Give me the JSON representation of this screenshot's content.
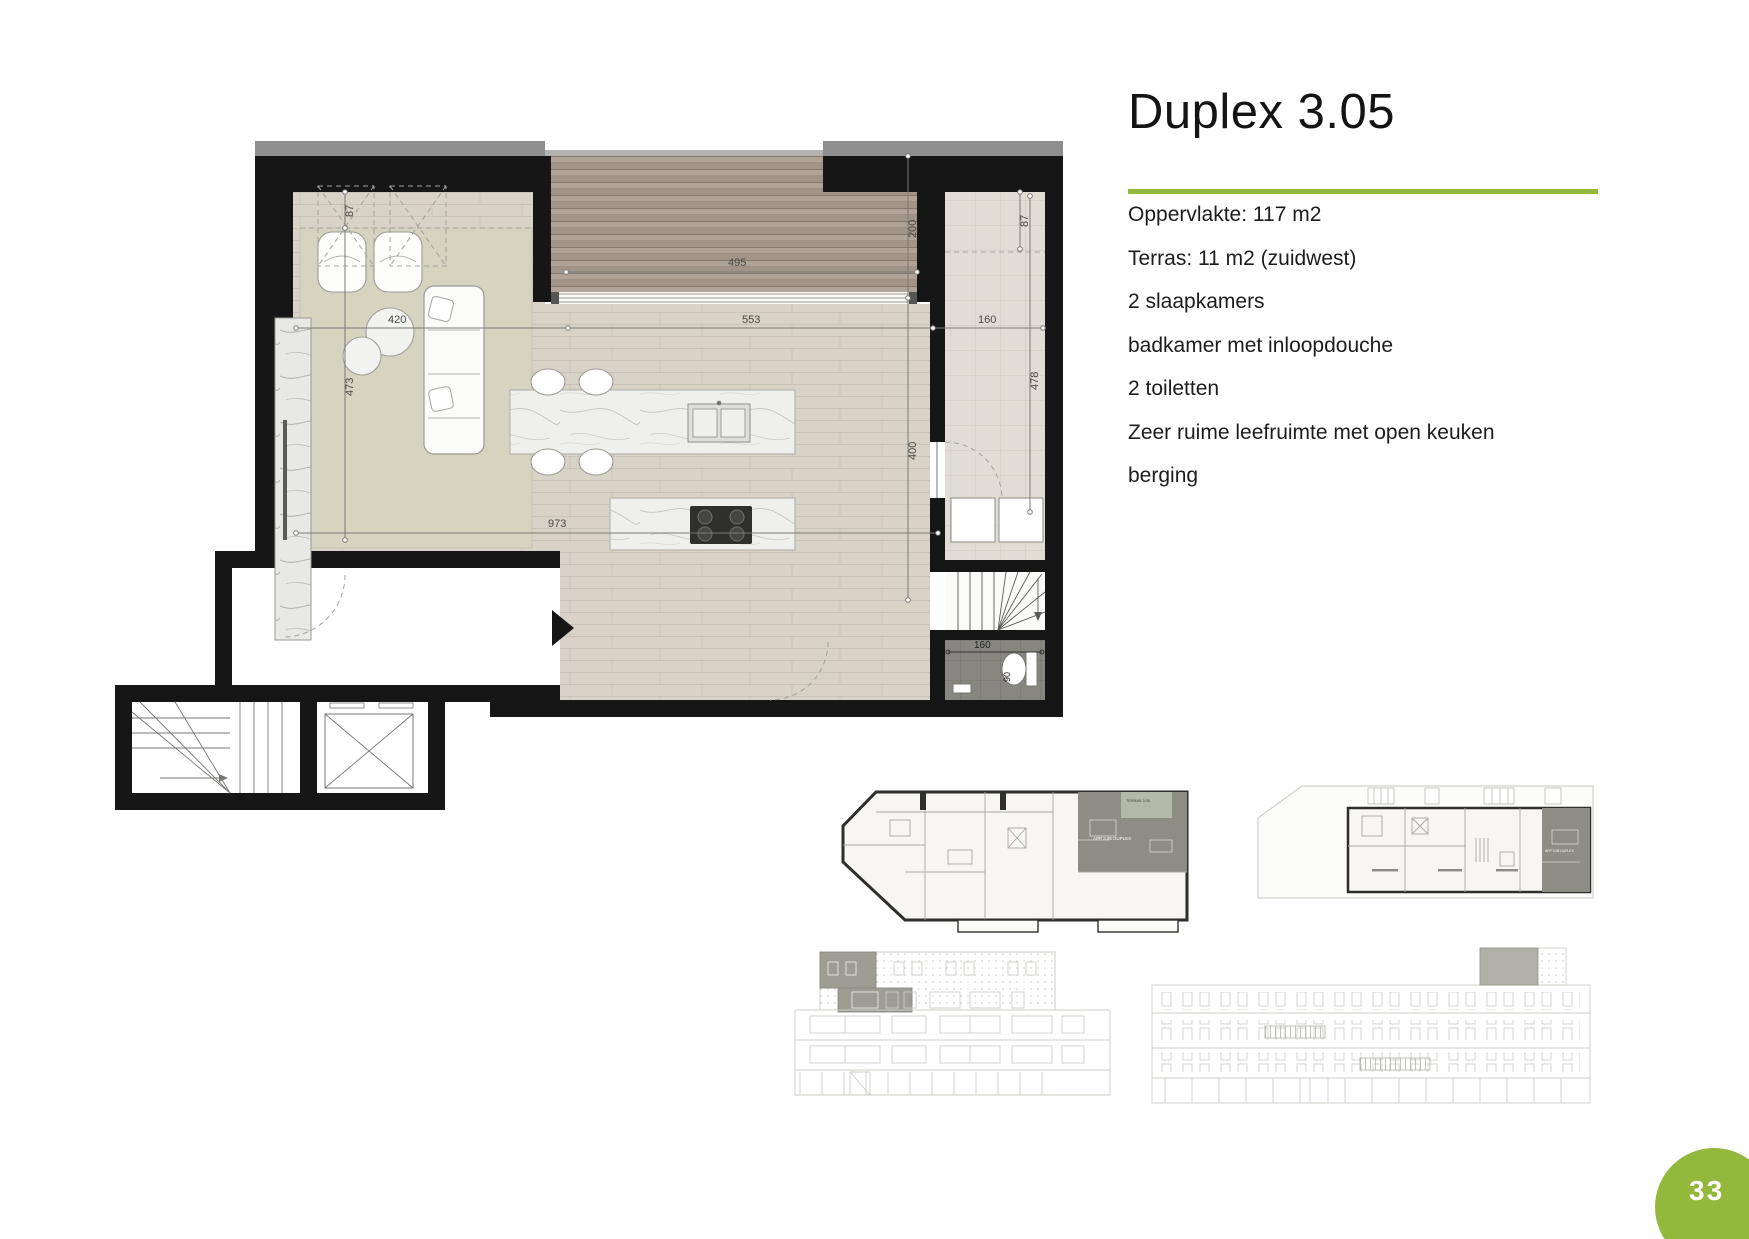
{
  "header": {
    "title": "Duplex 3.05"
  },
  "details": [
    "Oppervlakte: 117 m2",
    "Terras: 11 m2 (zuidwest)",
    "2 slaapkamers",
    "badkamer met inloopdouche",
    "2 toiletten",
    "Zeer ruime leefruimte met open keuken",
    "berging"
  ],
  "page": {
    "number": "33"
  },
  "colors": {
    "accent": "#93b93c",
    "wall": "#161616",
    "highlight_unit": "#8d8d83",
    "highlight_terrace": "#b2b9a7"
  },
  "floorplan": {
    "dims": {
      "left_87": "87",
      "right_87": "87",
      "terrace_depth_200": "200",
      "terrace_width_495": "495",
      "living_width_553": "553",
      "berging_width_160": "160",
      "left_height_473": "473",
      "rug_width_420": "420",
      "right_height_400": "400",
      "berging_height_478": "478",
      "total_width_973": "973",
      "shower_width_160": "160",
      "shower_depth_90": "90"
    }
  },
  "miniplan_left": {
    "unit_label": "APP 3.05 DUPLEX",
    "terrace_label": "TERRAS 3.05"
  },
  "miniplan_right": {
    "unit_label": "APP 3.05 DUPLEX"
  }
}
